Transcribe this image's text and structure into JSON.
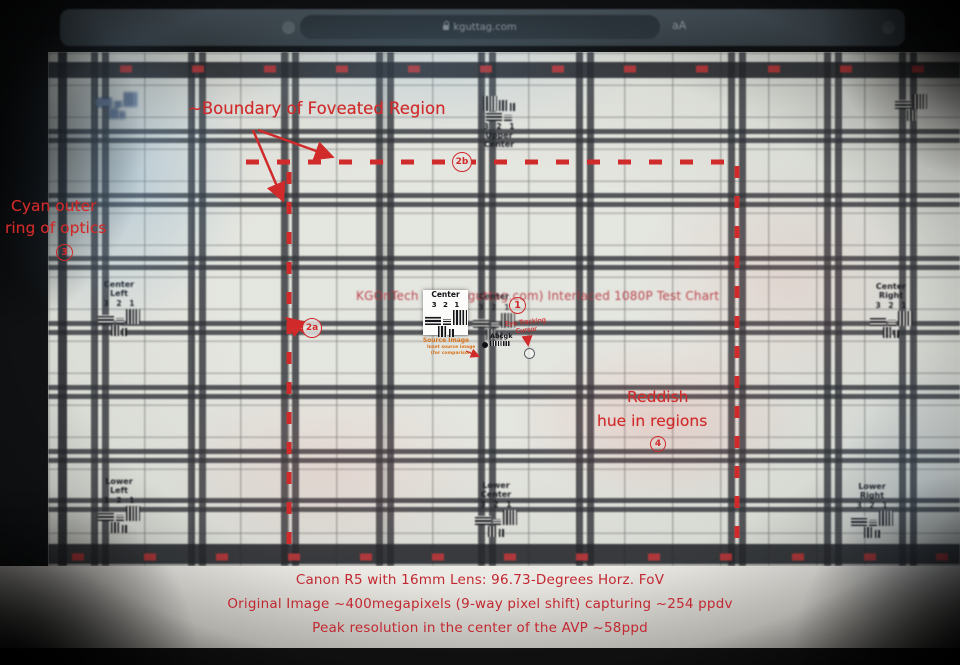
{
  "browser": {
    "url_text": "kguttag.com",
    "reader_button": "aA"
  },
  "chart": {
    "title": "KGOnTech (www.kguttag.com) Interlaced 1080P Test Chart",
    "scale_numbers": "3 2 1",
    "letters_sample": "Abcgk",
    "labels": {
      "upper_center_1": "Upper",
      "upper_center_2": "Center",
      "center_left_1": "Center",
      "center_left_2": "Left",
      "center": "Center",
      "center_right_1": "Center",
      "center_right_2": "Right",
      "lower_left_1": "Lower",
      "lower_left_2": "Left",
      "lower_center_1": "Lower",
      "lower_center_2": "Center",
      "lower_right_1": "Lower",
      "lower_right_2": "Right"
    },
    "inset": {
      "label": "Center",
      "caption_main": "Source Image",
      "caption_sub1": "Inset source image",
      "caption_sub2": "(for comparison)"
    }
  },
  "annotations": {
    "boundary_label": "~Boundary of Foveated Region",
    "cyan_label_line1": "Cyan outer",
    "cyan_label_line2": "ring of optics",
    "reddish_label_line1": "Reddish",
    "reddish_label_line2": "hue in regions",
    "eye_tracking_line1": "Eye Tracking",
    "eye_tracking_line2": "Cursor",
    "marker_1": "1",
    "marker_2a": "2a",
    "marker_2b": "2b",
    "marker_3": "3",
    "marker_4": "4"
  },
  "caption": {
    "line1": "Canon R5 with 16mm Lens: 96.73-Degrees Horz. FoV",
    "line2": "Original Image ~400megapixels (9-way pixel shift) capturing ~254 ppdv",
    "line3": "Peak resolution in the center of the AVP ~58ppd"
  },
  "colors": {
    "ann_red": "#d02a2a",
    "cap_red": "#c22831",
    "ttl_red": "#b5353e",
    "org": "#d8731c",
    "cyan_tint": "#6ea5d2",
    "chart_ink": "#15161b"
  }
}
